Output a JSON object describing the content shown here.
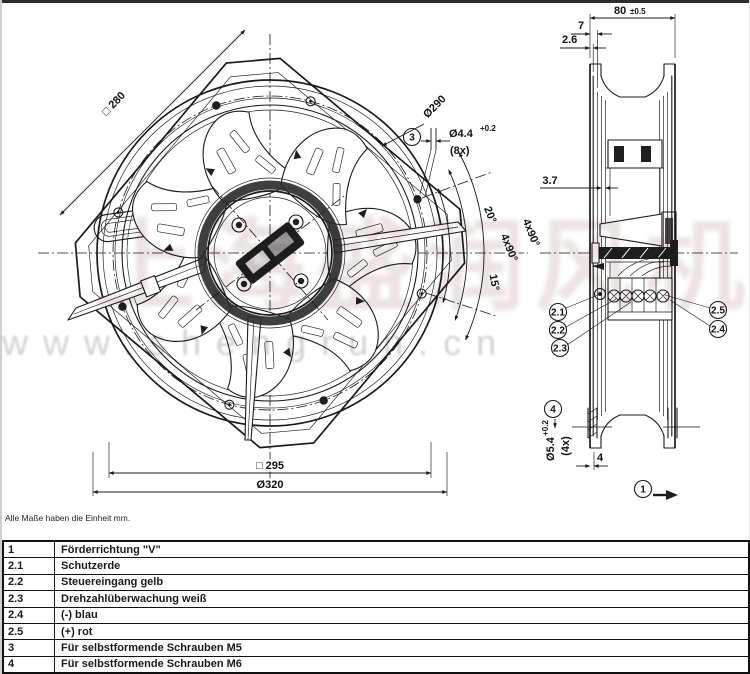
{
  "note": "Alle Maße haben die Einheit mm.",
  "watermark": {
    "cjk": "上海盛润风机",
    "url": "www.shengrun.cn"
  },
  "front_view": {
    "dim_square_outer": "□ 280",
    "dim_bolt_circle": "Ø290",
    "callout_3": "3",
    "dim_hole": "Ø4.4",
    "dim_hole_tol": "+0.2",
    "dim_hole_count": "(8x)",
    "angle_20": "20°",
    "angle_4x90_a": "4x90°",
    "angle_4x90_b": "4x90°",
    "angle_15": "15°",
    "dim_square_holes": "□ 295",
    "dim_outer_dia": "Ø320"
  },
  "side_view": {
    "dim_depth": "80",
    "dim_depth_tol": "±0.5",
    "dim_7": "7",
    "dim_2_6": "2.6",
    "dim_3_7": "3.7",
    "callout_2_1": "2.1",
    "callout_2_2": "2.2",
    "callout_2_3": "2.3",
    "callout_2_4": "2.4",
    "callout_2_5": "2.5",
    "callout_4": "4",
    "dim_flange_hole": "Ø5.4",
    "dim_flange_hole_tol": "+0.2",
    "dim_flange_hole_count": "(4x)",
    "dim_4": "4",
    "callout_1": "1"
  },
  "legend": {
    "rows": [
      {
        "id": "1",
        "text": "Förderrichtung \"V\""
      },
      {
        "id": "2.1",
        "text": "Schutzerde"
      },
      {
        "id": "2.2",
        "text": "Steuereingang gelb"
      },
      {
        "id": "2.3",
        "text": "Drehzahlüberwachung weiß"
      },
      {
        "id": "2.4",
        "text": "(-) blau"
      },
      {
        "id": "2.5",
        "text": "(+) rot"
      },
      {
        "id": "3",
        "text": "Für selbstformende Schrauben M5"
      },
      {
        "id": "4",
        "text": "Für selbstformende Schrauben M6"
      }
    ]
  },
  "colors": {
    "line": "#1a1a1a",
    "watermark_cjk": "#d9c6c6",
    "watermark_url": "#c6c6c6"
  }
}
